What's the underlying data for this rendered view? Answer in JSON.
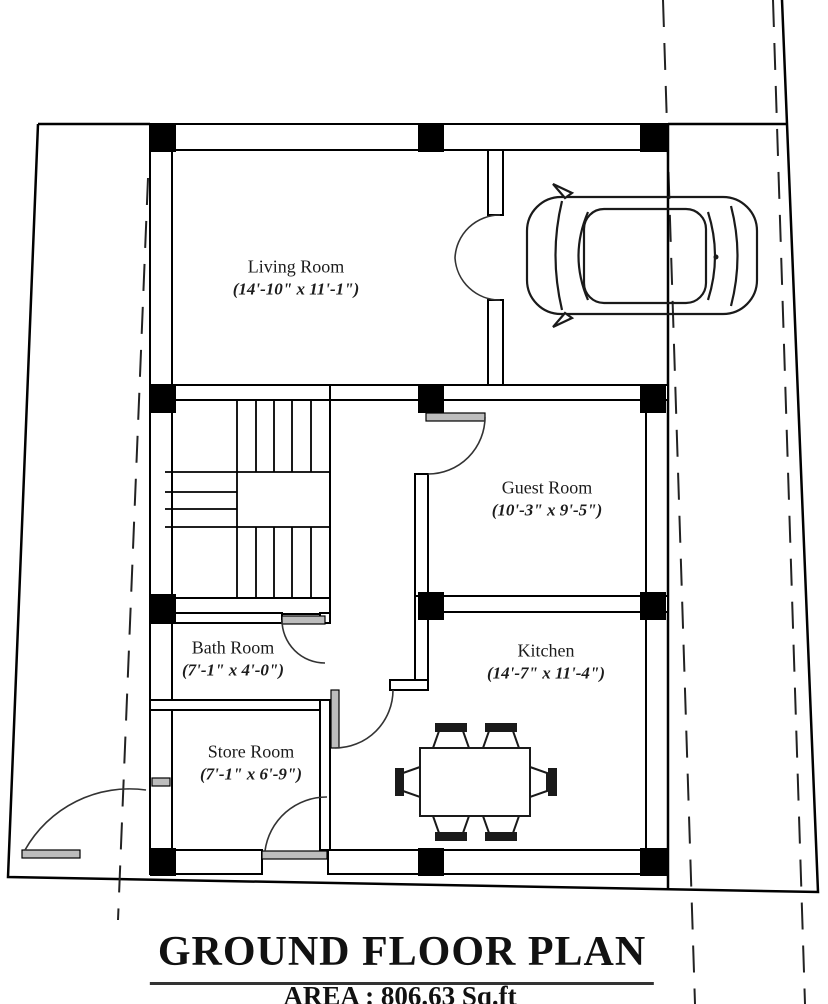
{
  "plan": {
    "title": "GROUND FLOOR PLAN",
    "area_label": "AREA : 806.63 Sq.ft",
    "rooms": [
      {
        "name": "Living Room",
        "dimensions": "(14'-10\" x 11'-1\")"
      },
      {
        "name": "Guest Room",
        "dimensions": "(10'-3\" x 9'-5\")"
      },
      {
        "name": "Kitchen",
        "dimensions": "(14'-7\" x 11'-4\")"
      },
      {
        "name": "Bath Room",
        "dimensions": "(7'-1\" x 4'-0\")"
      },
      {
        "name": "Store Room",
        "dimensions": "(7'-1\" x 6'-9\")"
      }
    ],
    "colors": {
      "line": "#000000",
      "background": "#ffffff",
      "door_leaf": "#bdbdbd",
      "column_fill": "#000000"
    }
  }
}
